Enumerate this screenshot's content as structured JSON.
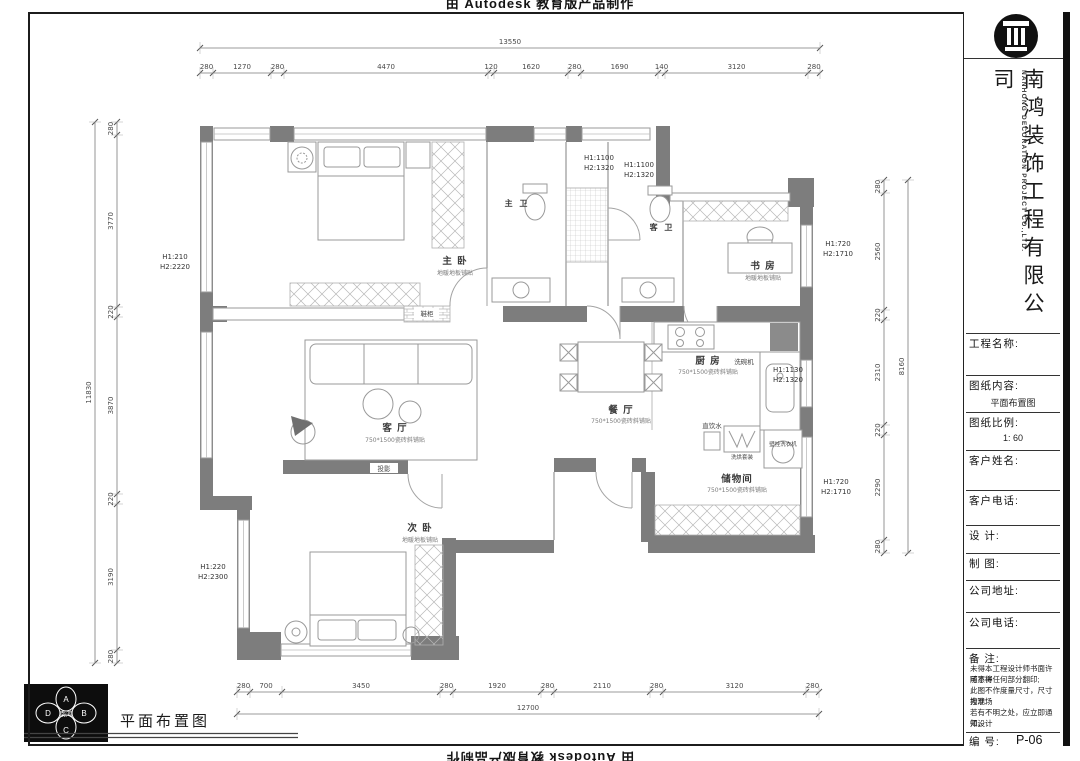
{
  "watermark": {
    "text": "由 Autodesk 教育版产品制作"
  },
  "stamp": {
    "label": "平面布置图",
    "top": "A",
    "right": "B",
    "bottom": "C",
    "left": "D",
    "center": "南鸿"
  },
  "title_block": {
    "company_cn": "南鸿装饰工程有限公司",
    "company_en": "NANHONG DECORATION PROJECT CO.,LTD.",
    "project_label": "工程名称:",
    "content_label": "图纸内容:",
    "content_value": "平面布置图",
    "scale_label": "图纸比例:",
    "scale_value": "1: 60",
    "client_label": "客户姓名:",
    "client_phone_label": "客户电话:",
    "designer_label": "设  计:",
    "drafter_label": "制  图:",
    "address_label": "公司地址:",
    "phone_label": "公司电话:",
    "notes_label": "备  注:",
    "notes": [
      "未得本工程设计师书面许可不得",
      "随意将任何部分翻印;",
      "此图不作度量尺寸，尺寸按现场",
      "为准;",
      "若有不明之处，应立即通知设计",
      "师。"
    ],
    "number_label": "编  号:",
    "number_value": "P-06"
  },
  "plan": {
    "rooms": {
      "master": {
        "name": "主  卧",
        "floor": "地暖地板铺贴"
      },
      "master_bath": {
        "name": "主 卫"
      },
      "guest_bath": {
        "name": "客 卫"
      },
      "study": {
        "name": "书  房",
        "floor": "地暖地板铺贴"
      },
      "kitchen": {
        "name": "厨  房",
        "floor": "750*1500瓷砖斜铺贴"
      },
      "dining": {
        "name": "餐 厅",
        "floor": "750*1500瓷砖斜铺贴"
      },
      "living": {
        "name": "客 厅",
        "floor": "750*1500瓷砖斜铺贴"
      },
      "second": {
        "name": "次  卧",
        "floor": "地暖地板铺贴"
      },
      "storage": {
        "name": "储物间",
        "floor": "750*1500瓷砖斜铺贴"
      }
    },
    "annotations": {
      "dishwasher": "洗碗机",
      "water": "直饮水",
      "washer": "壁挂洗衣机",
      "washer_set": "洗烘套装",
      "shoe_cabinet": "鞋柜",
      "projector": "投影"
    },
    "heights": {
      "left": {
        "h1": "H1:210",
        "h2": "H2:2220"
      },
      "entry1": {
        "h1": "H1:1100",
        "h2": "H2:1320"
      },
      "entry2": {
        "h1": "H1:1100",
        "h2": "H2:1320"
      },
      "study": {
        "h1": "H1:720",
        "h2": "H2:1710"
      },
      "kitchen": {
        "h1": "H1:1130",
        "h2": "H2:1320"
      },
      "storage": {
        "h1": "H1:720",
        "h2": "H2:1710"
      },
      "second": {
        "h1": "H1:220",
        "h2": "H2:2300"
      }
    }
  },
  "dims": {
    "top": {
      "total": "13550",
      "segments": [
        "280",
        "1270",
        "280",
        "4470",
        "120",
        "1620",
        "280",
        "1690",
        "140",
        "3120",
        "280"
      ]
    },
    "bottom": {
      "total": "12700",
      "segments": [
        "280",
        "700",
        "3450",
        "280",
        "1920",
        "280",
        "2110",
        "280",
        "3120",
        "280"
      ]
    },
    "left": {
      "total": "11830",
      "segments": [
        "280",
        "3770",
        "220",
        "3870",
        "220",
        "3190",
        "280"
      ]
    },
    "right": {
      "total": "8160",
      "segments": [
        "280",
        "2560",
        "220",
        "2310",
        "220",
        "2290",
        "280"
      ]
    }
  }
}
